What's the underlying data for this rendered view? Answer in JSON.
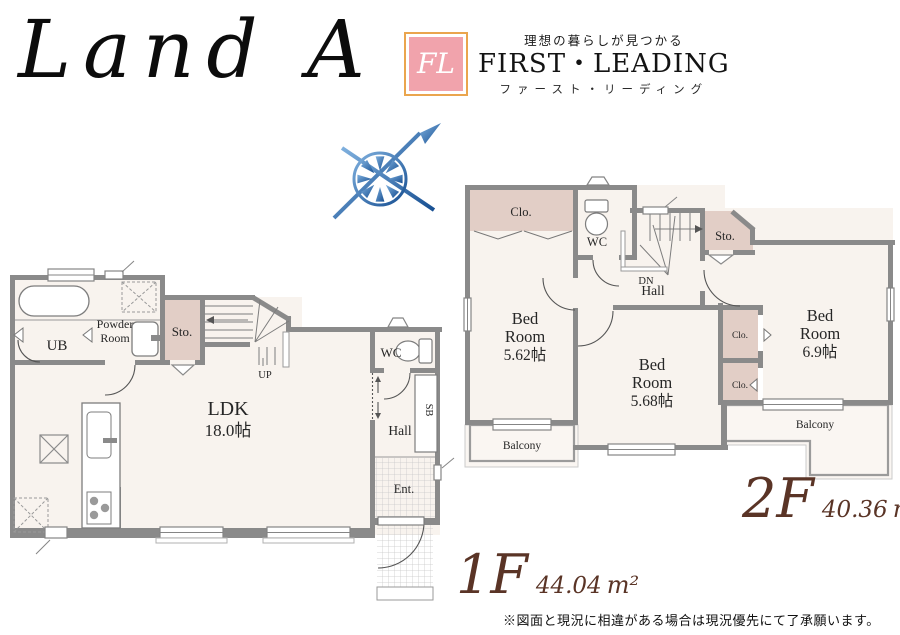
{
  "title": "Land A",
  "logo": {
    "monogram": "FL",
    "tagline": "理想の暮らしが見つかる",
    "brand": "FIRST・LEADING",
    "kana": "ファースト・リーディング"
  },
  "floor1": {
    "label": "1F",
    "area": "44.04",
    "unit": "m²",
    "rooms": {
      "ub": "UB",
      "powder1": "Powder",
      "powder2": "Room",
      "sto": "Sto.",
      "up": "UP",
      "ldk": "LDK",
      "ldk_size": "18.0帖",
      "wc": "WC",
      "hall": "Hall",
      "sb": "SB",
      "ent": "Ent."
    }
  },
  "floor2": {
    "label": "2F",
    "area": "40.36",
    "unit": "m²",
    "rooms": {
      "clo_top": "Clo.",
      "wc": "WC",
      "dn": "DN",
      "sto": "Sto.",
      "hall": "Hall",
      "bed1_1": "Bed",
      "bed1_2": "Room",
      "bed1_size": "5.62帖",
      "bed2_1": "Bed",
      "bed2_2": "Room",
      "bed2_size": "5.68帖",
      "bed3_1": "Bed",
      "bed3_2": "Room",
      "bed3_size": "6.9帖",
      "clo_a": "Clo.",
      "clo_b": "Clo.",
      "balcony_left": "Balcony",
      "balcony_right": "Balcony"
    }
  },
  "disclaimer": "※図面と現況に相違がある場合は現況優先にて了承願います。",
  "colors": {
    "wall": "#8a8a8a",
    "floor": "#f8f3ee",
    "closet": "#e2cec6",
    "accent_brown": "#5a3426",
    "logo_pink": "#f1a3ac",
    "logo_orange": "#eaa54e",
    "compass_blue": "#2e74b5"
  }
}
